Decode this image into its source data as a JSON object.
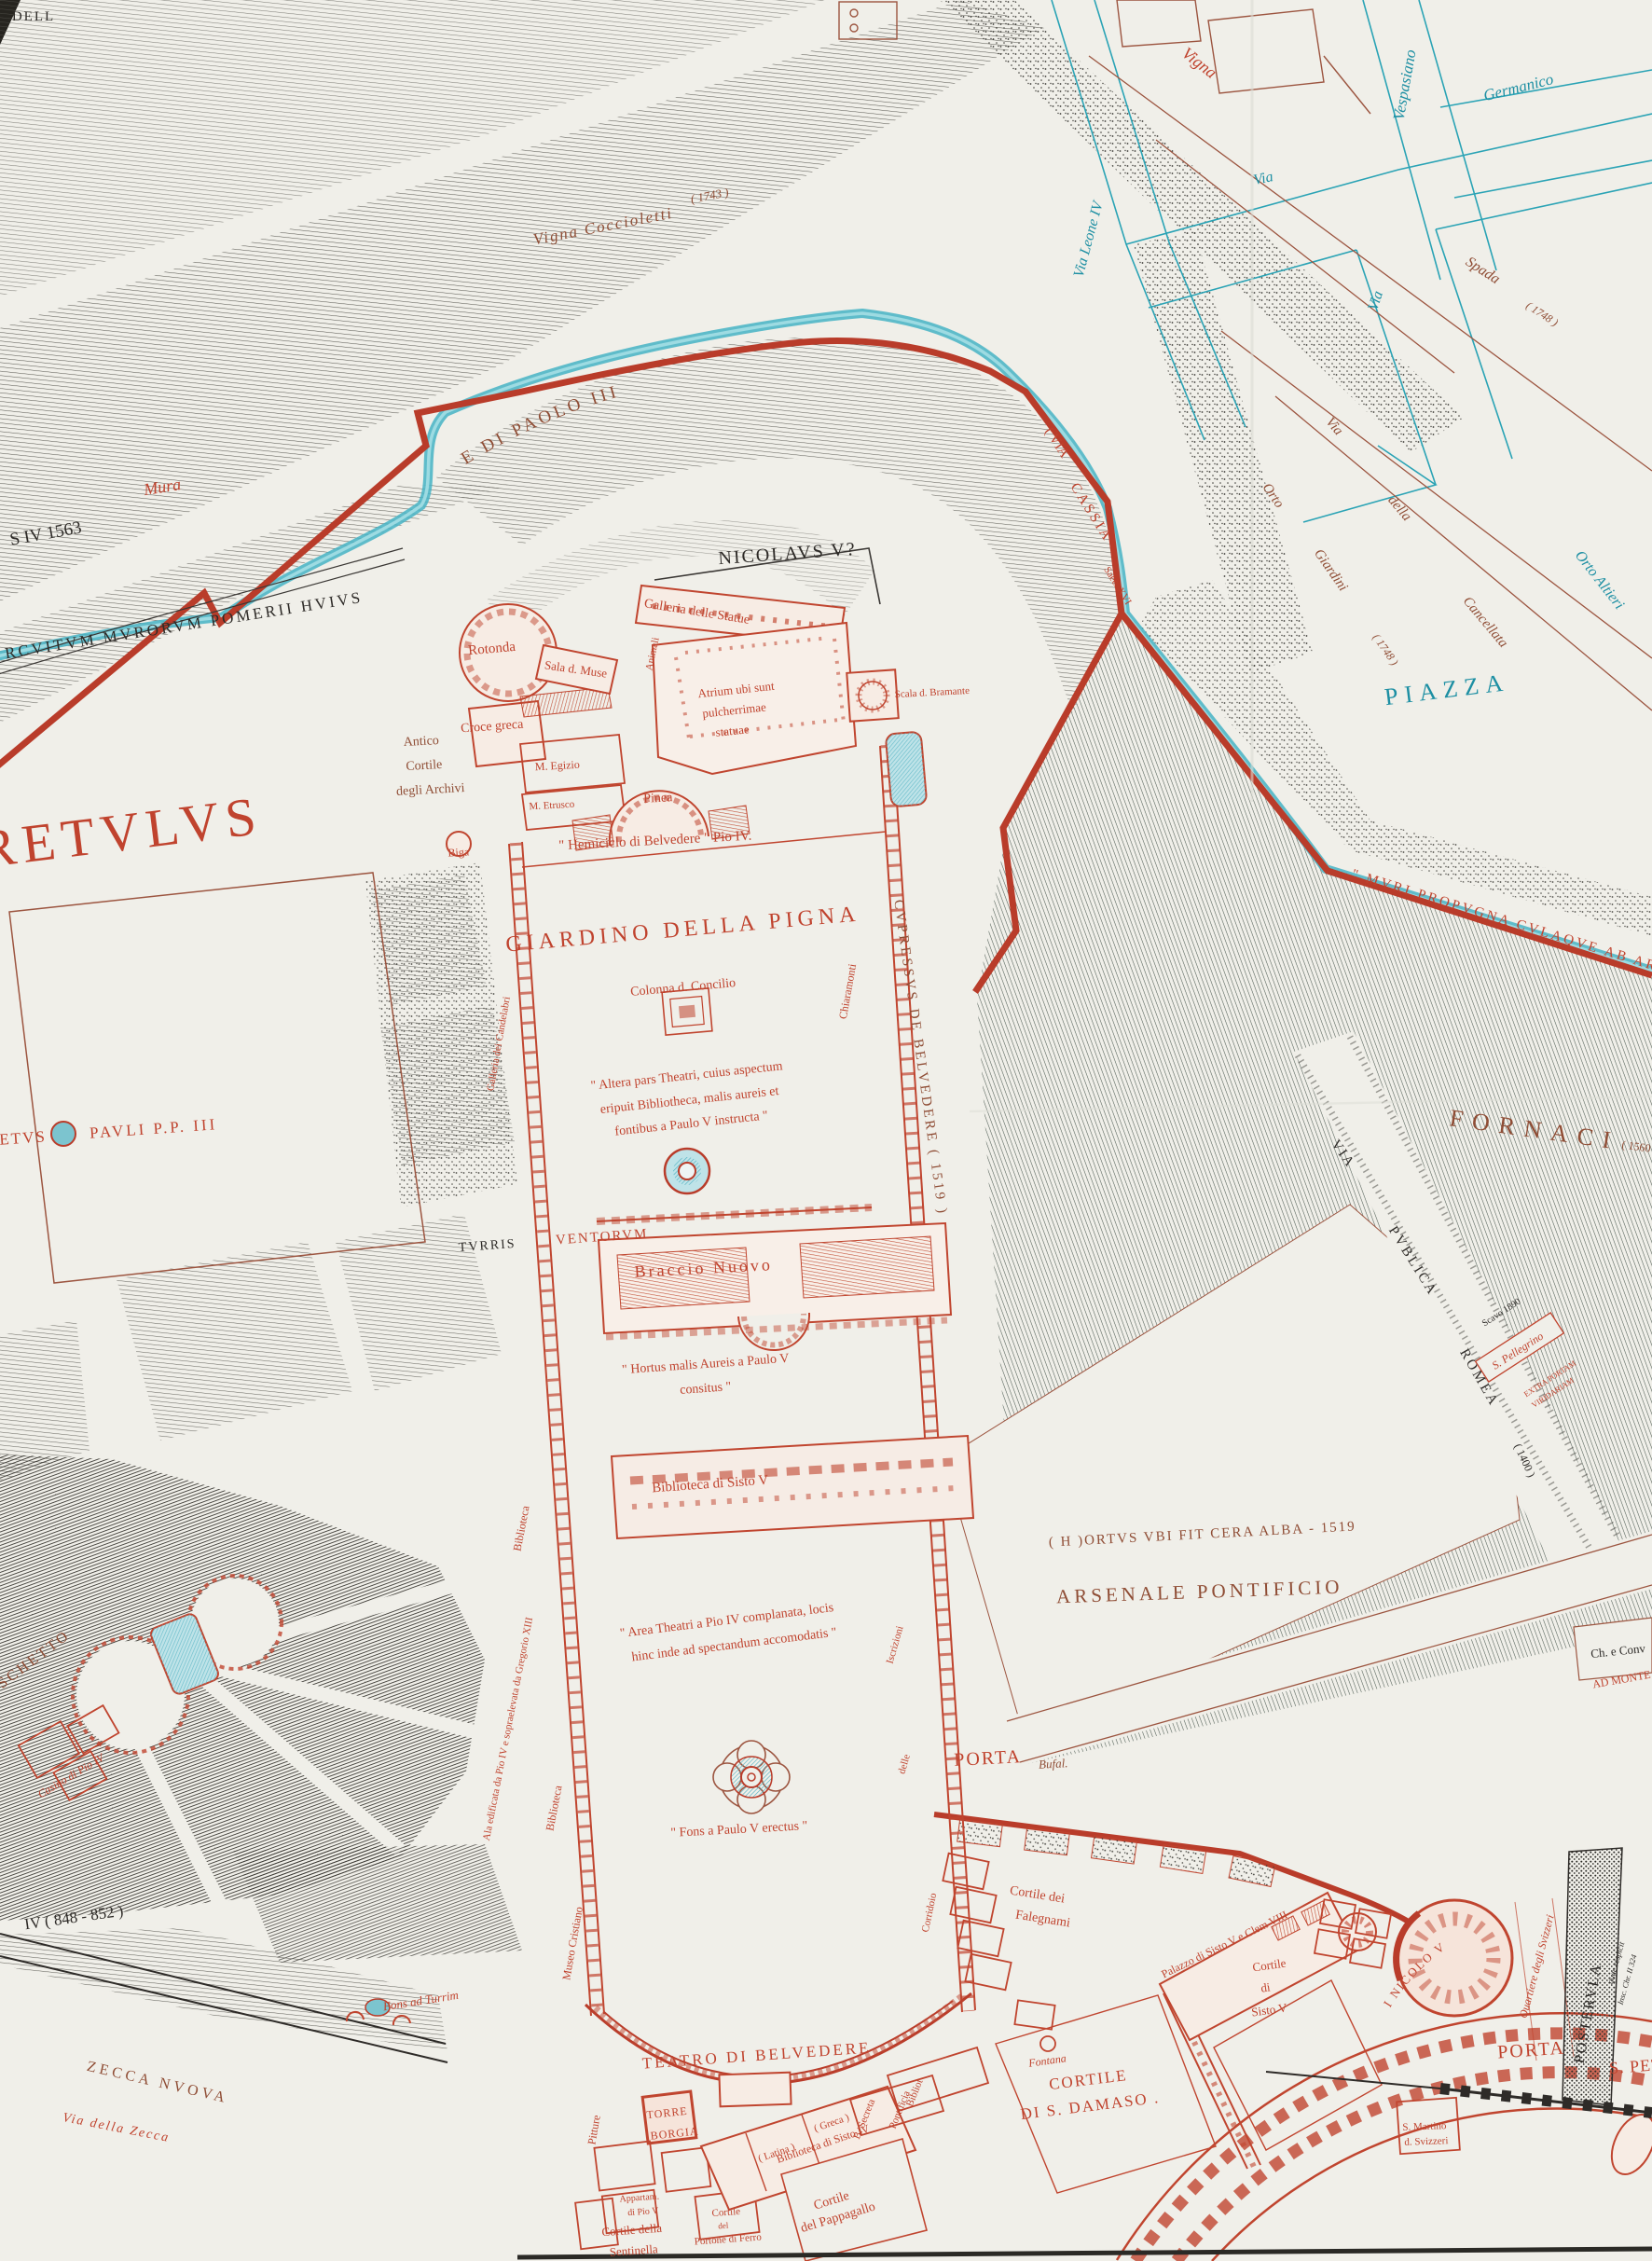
{
  "palette": {
    "paper": "#f0efe9",
    "building_red": "#c0452f",
    "wall_red": "#b93c2a",
    "stream_teal": "#45b3c4",
    "street_teal": "#1d8fa3",
    "label_brown": "#8f4d35",
    "label_black": "#2e2b28",
    "moat_dark": "#3d4a42"
  },
  "labels": {
    "nw": {
      "edge_fragment": "DELL",
      "wall_date": "S IV  1563",
      "pomerii": "RCVITVM  MVRORVM  POMERII  HVIVS",
      "mura": "Mura",
      "vigna_coccioletti": "Vigna  Coccioletti",
      "vigna_coccioletti_year": "( 1743 )",
      "bastione": "BASTIONE  DI  PAOLO  III",
      "nicolaus": "NICOLAVS V?"
    },
    "streets": {
      "vigna": "Vigna",
      "vespasiano": "Vespasiano",
      "germanico": "Germanico",
      "via_1": "Via",
      "via_2": "Via",
      "via_leone_iv": "Via  Leone  IV",
      "spada": "Spada",
      "spada_year": "( 1748 )",
      "via_w": "Via",
      "della_w": "della",
      "cancellata_w": "Cancellata",
      "orto_w": "Orto",
      "giardini_w": "Giardini",
      "giardini_year": "( 1748 )",
      "orto_altieri": "Orto  Altieri",
      "piazza": "PIAZZA",
      "via_cassia_1": "( VIA",
      "via_cassia_2": "CASSIA",
      "via_cassia_3": "Saec. XVI"
    },
    "museums": {
      "galleria_statue": "Galleria  delle  Statue",
      "rotonda": "Rotonda",
      "sala_muse": "Sala  d.  Muse",
      "animali": "Animali",
      "atrium_1": "Atrium ubi sunt",
      "atrium_2": "pulcherrimae",
      "atrium_3": "statuae",
      "scala_bramante": "Scala d. Bramante",
      "croce_greca": "Croce  greca",
      "antico_1": "Antico",
      "antico_2": "Cortile",
      "antico_3": "degli  Archivi",
      "m_egizio": "M. Egizio",
      "m_etrusco": "M. Etrusco",
      "pinea": "Pinea",
      "biga": "Biga",
      "hemiciclo": "\" Hemiciclo  di  Belvedere \"  Pio IV."
    },
    "court": {
      "giardino_pigna": "GIARDINO  DELLA  PIGNA",
      "colonna": "Colonna  d.  Concilio",
      "altera_1": "\" Altera  pars  Theatri, cuius  aspectum",
      "altera_2": "eripuit   Bibliotheca,  malis  aureis et",
      "altera_3": "fontibus   a   Paulo V  instructa \"",
      "chiaramonti": "Chiaramonti",
      "cupressus": "CVPRESSVS   DE   BELVEDERE   ( 1519 )",
      "turris": "TVRRIS",
      "ventorum": "VENTORVM",
      "braccio_nuovo": "Braccio   Nuovo",
      "hortus_1": "\" Hortus  malis  Aureis  a  Paulo V",
      "hortus_2": "consitus \"",
      "biblioteca_sisto_v": "Biblioteca  di  Sisto V",
      "area_1": "\" Area  Theatri  a  Pio IV  complanata, locis",
      "area_2": "hinc  inde  ad  spectandum  accomodatis \"",
      "fons_paulo": "\" Fons  a  Paulo V  erectus \"",
      "ala_gregorio": "Ala  edificata  da  Pio IV  e  sopraelevata  da  Gregorio XIII",
      "biblioteca_a": "Biblioteca",
      "biblioteca_b": "Biblioteca",
      "galleria_candelabri": "Galleria  dei  Candelabri",
      "museo_cristiano": "Museo  Cristiano",
      "iscrizioni": "Iscrizioni",
      "delle": "delle",
      "corridoio": "Corridoio"
    },
    "east": {
      "muri": "\" MVRI  PROPVGNA CVLAQVE  AB  ARCE",
      "fornaci": "FORNACI",
      "fornaci_year": "( 1560 )",
      "via_publica_1": "VIA",
      "via_publica_2": "PVBLICA",
      "via_publica_3": "ROMEA",
      "via_publica_year": "( 1400 )",
      "scavo": "Scavo 1890",
      "pellegrino": "S. Pellegrino",
      "extra_1": "EXTRA  PORTAM",
      "extra_2": "VIRIDARIAM",
      "ch_e_conv": "Ch. e Conv",
      "ad_monte": "AD MONTE",
      "hortus_cera": "( H )ORTVS  VBI  FIT  CERA  ALBA - 1519",
      "arsenale": "ARSENALE   PONTIFICIO"
    },
    "west": {
      "retulus": "RETVLVS",
      "etus": "ETVS",
      "pauli": "PAVLI   P.P. III",
      "boschetto": "BOSCHETTO",
      "casino": "Casino di Pio IV"
    },
    "south": {
      "porta_bufal": "PORTA",
      "bufal": "Bufal.",
      "falegnami_1": "Cortile  dei",
      "falegnami_2": "Falegnami",
      "palazzo_sisto": "Palazzo  di  Sisto V  e  Clem VIII",
      "cortile_sisto_1": "Cortile",
      "cortile_sisto_2": "di",
      "cortile_sisto_3": "Sisto V",
      "fontana": "Fontana",
      "teatro": "TEATRO  DI  BELVEDERE",
      "torre_1": "TORRE",
      "torre_2": "BORGIA",
      "pitture": "Pitture",
      "appartam_1": "Appartam.",
      "appartam_2": "di  Pio V",
      "sentinella_1": "Cortile  della",
      "sentinella_2": "Sentinella",
      "portone_1": "Cortile",
      "portone_2": "del",
      "portone_3": "Portone di Ferro",
      "latina": "( Latina )",
      "biblioteca_iv": "Biblioteca  di  Sisto IV",
      "greca": "( Greca )",
      "b_secreta": "B. Secreta",
      "bibliot": "Bibliot",
      "pontificia": "Pontificia",
      "pappagallo_1": "Cortile",
      "pappagallo_2": "del  Pappagallo",
      "damaso_1": "CORTILE",
      "damaso_2": "DI  S. DAMASO .",
      "s_martino_1": "S. Martino",
      "s_martino_2": "d.  Svizzeri",
      "torre_nicolo": "TORRE  DI  NICOLO  V",
      "quartiere": "Quartiere  degli  Svizzeri",
      "porta": "PORTA",
      "s_pet": "S. PET",
      "postervla": "POSTERVLA",
      "quae": "quae respicit",
      "insc": "Insc. Chr. II 324"
    },
    "sw": {
      "wall_date": "IV  ( 848 - 852 )",
      "fons_turrim": "Fons ad Turrim",
      "zecca": "ZECCA  NVOVA",
      "via_zecca": "Via   della   Zecca"
    }
  }
}
